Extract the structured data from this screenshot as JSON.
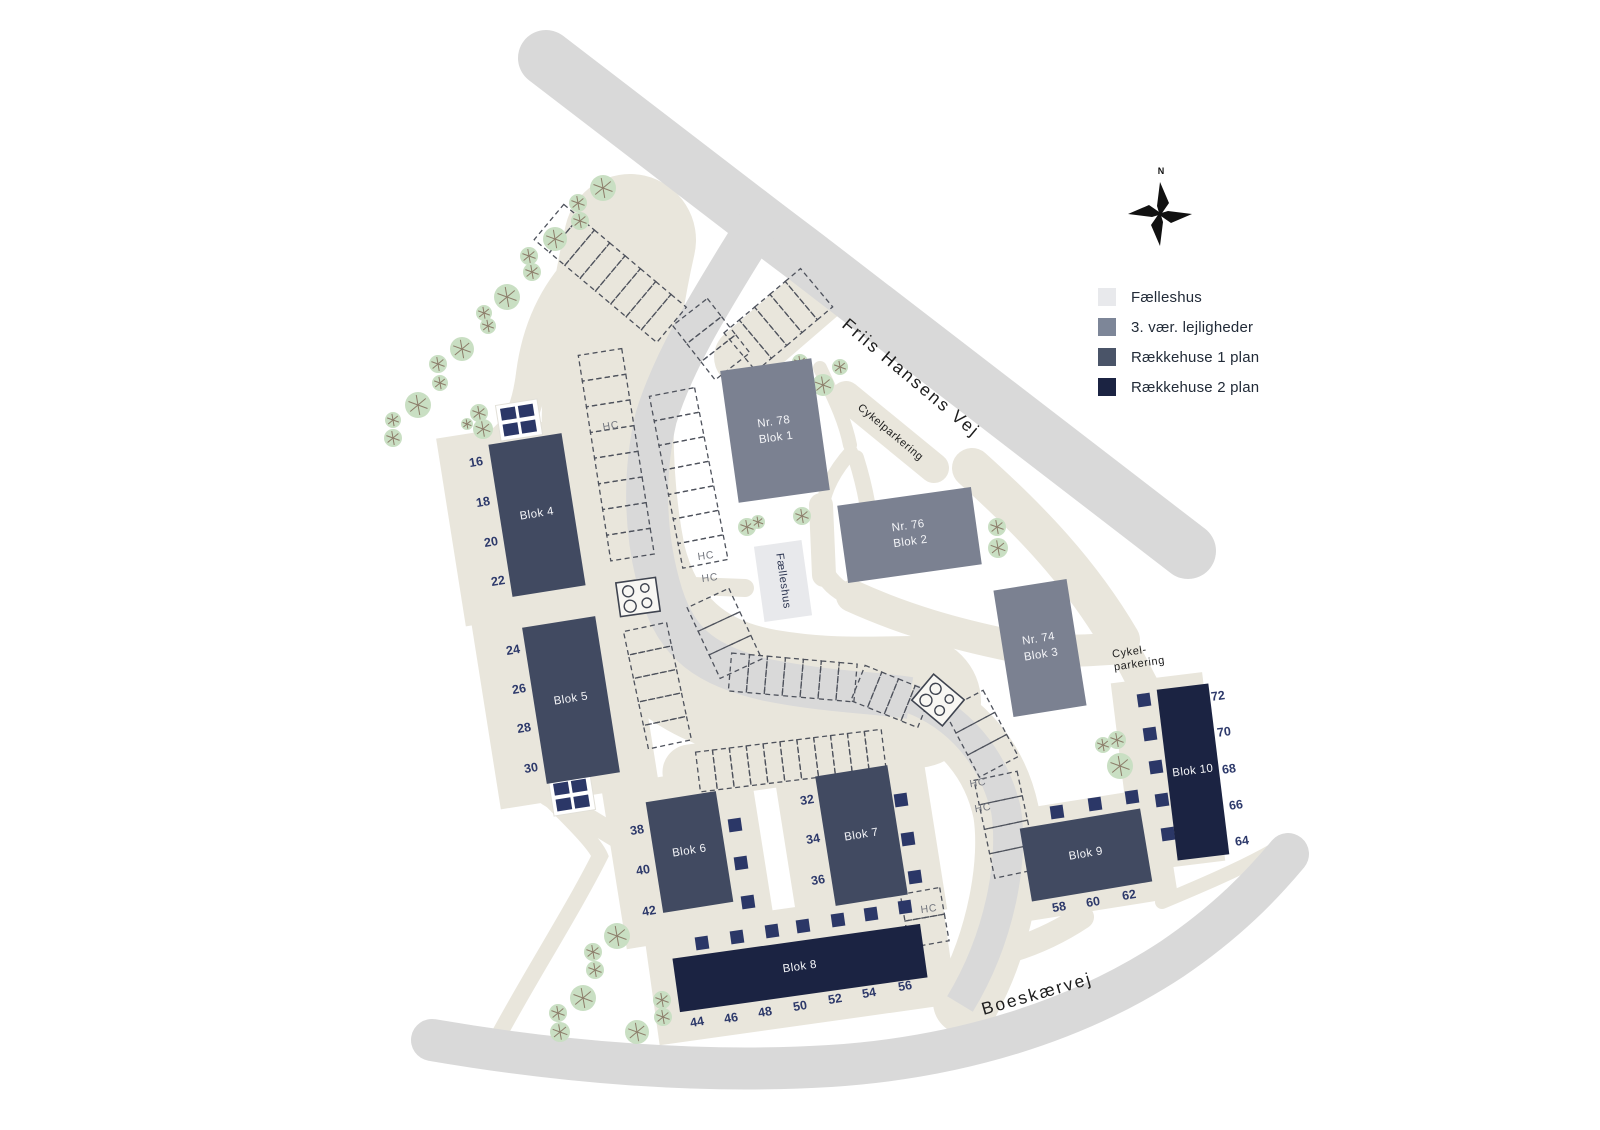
{
  "legend": {
    "items": [
      {
        "label": "Fælleshus",
        "color": "#e8e9ec"
      },
      {
        "label": "3. vær. lejligheder",
        "color": "#7d8698"
      },
      {
        "label": "Rækkehuse 1 plan",
        "color": "#4a5468"
      },
      {
        "label": "Rækkehuse 2 plan",
        "color": "#1b2342"
      }
    ]
  },
  "compass": {
    "north_label": "N"
  },
  "roads": {
    "friis_hansens_vej": "Friis Hansens Vej",
    "boeskaervej": "Boeskærvej"
  },
  "labels": {
    "hc": "HC",
    "cykelparkering": "Cykelparkering",
    "cykelparkering_line1": "Cykel-",
    "cykelparkering_line2": "parkering"
  },
  "buildings": {
    "blok1": {
      "line1": "Nr. 78",
      "line2": "Blok 1",
      "type": "3. vær. lejligheder"
    },
    "blok2": {
      "line1": "Nr. 76",
      "line2": "Blok 2",
      "type": "3. vær. lejligheder"
    },
    "blok3": {
      "line1": "Nr. 74",
      "line2": "Blok 3",
      "type": "3. vær. lejligheder"
    },
    "blok4": {
      "label": "Blok 4",
      "type": "Rækkehuse 1 plan",
      "numbers": [
        "16",
        "18",
        "20",
        "22"
      ]
    },
    "blok5": {
      "label": "Blok 5",
      "type": "Rækkehuse 1 plan",
      "numbers": [
        "24",
        "26",
        "28",
        "30"
      ]
    },
    "blok6": {
      "label": "Blok 6",
      "type": "Rækkehuse 1 plan",
      "numbers": [
        "38",
        "40",
        "42"
      ]
    },
    "blok7": {
      "label": "Blok 7",
      "type": "Rækkehuse 1 plan",
      "numbers": [
        "32",
        "34",
        "36"
      ]
    },
    "blok8": {
      "label": "Blok 8",
      "type": "Rækkehuse 2 plan",
      "numbers": [
        "44",
        "46",
        "48",
        "50",
        "52",
        "54",
        "56"
      ]
    },
    "blok9": {
      "label": "Blok 9",
      "type": "Rækkehuse 1 plan",
      "numbers": [
        "58",
        "60",
        "62"
      ]
    },
    "blok10": {
      "label": "Blok 10",
      "type": "Rækkehuse 2 plan",
      "numbers": [
        "64",
        "66",
        "68",
        "70",
        "72"
      ]
    },
    "faelleshus": {
      "label": "Fælleshus",
      "type": "Fælleshus"
    }
  }
}
